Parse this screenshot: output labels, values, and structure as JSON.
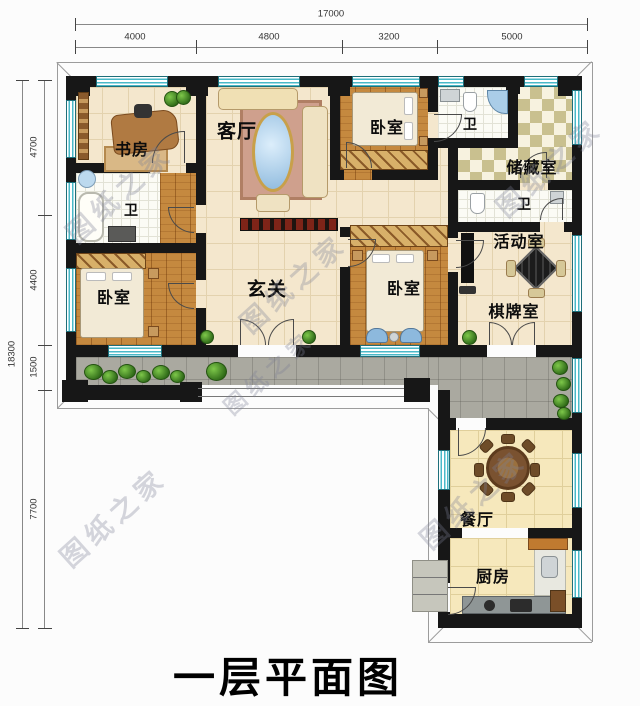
{
  "title": {
    "text": "一层平面图"
  },
  "watermark": {
    "text": "图纸之家"
  },
  "dimensions": {
    "top": {
      "total": "17000",
      "segments": [
        "4000",
        "4800",
        "3200",
        "5000"
      ]
    },
    "left": {
      "total": "18300",
      "segments": [
        "4700",
        "4400",
        "1500",
        "7700"
      ]
    }
  },
  "rooms": [
    {
      "id": "study",
      "label": "书房"
    },
    {
      "id": "living-room",
      "label": "客厅"
    },
    {
      "id": "bedroom-top",
      "label": "卧室"
    },
    {
      "id": "bath-top",
      "label": "卫"
    },
    {
      "id": "storage-room",
      "label": "储藏室"
    },
    {
      "id": "bath-right",
      "label": "卫"
    },
    {
      "id": "activity-room",
      "label": "活动室"
    },
    {
      "id": "chess-room",
      "label": "棋牌室"
    },
    {
      "id": "foyer",
      "label": "玄关"
    },
    {
      "id": "bedroom-middle",
      "label": "卧室"
    },
    {
      "id": "bath-left",
      "label": "卫"
    },
    {
      "id": "bedroom-left",
      "label": "卧室"
    },
    {
      "id": "dining-room",
      "label": "餐厅"
    },
    {
      "id": "kitchen",
      "label": "厨房"
    }
  ],
  "colors": {
    "wall": "#171717",
    "window": "#49b9c8",
    "wood_floor": "#c5893f",
    "tile_floor": "#f4e7cd",
    "terrace": "#aaa9a0",
    "checker": "#c9c08f",
    "kitchen_floor": "#f6e8bc"
  }
}
